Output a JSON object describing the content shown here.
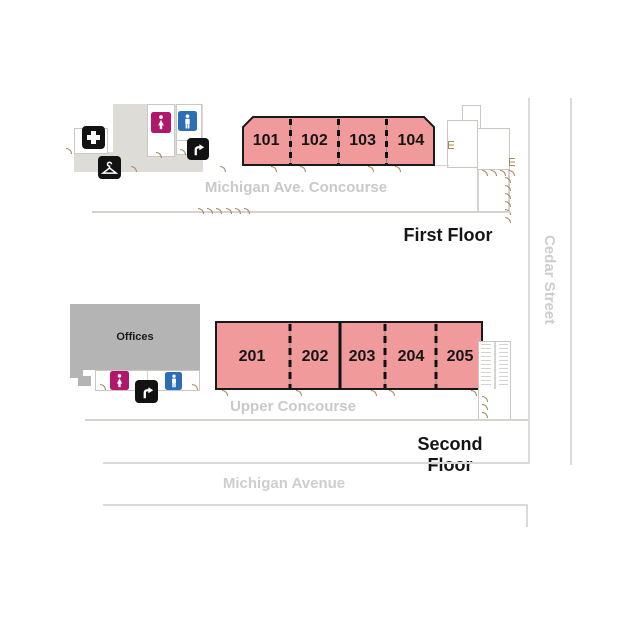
{
  "floors": {
    "first": {
      "title": "First Floor",
      "concourse": "Michigan Ave. Concourse",
      "rooms": [
        "101",
        "102",
        "103",
        "104"
      ]
    },
    "second": {
      "title": "Second Floor",
      "concourse": "Upper Concourse",
      "offices": "Offices",
      "rooms": [
        "201",
        "202",
        "203",
        "204",
        "205"
      ]
    }
  },
  "streets": {
    "cedar": "Cedar Street",
    "michigan": "Michigan Avenue"
  },
  "icons": {
    "first_aid": "first-aid-cross",
    "coat_check": "coat-hanger",
    "womens_restroom": "woman-figure",
    "mens_restroom": "man-figure",
    "escalator": "escalator-up-arrow"
  },
  "colors": {
    "room_fill": "#F19A9B",
    "room_border": "#1A1A1A",
    "footprint_gray": "#DEDCD7",
    "offices_gray": "#B4B4B4",
    "outline_gray": "#CBC8C3",
    "street_line": "#DADADA",
    "label_gray": "#C9C9C9",
    "door_glyph": "#A68B5C",
    "womens_bg": "#B1186C",
    "mens_bg": "#2C6EB5",
    "icon_bg": "#121212"
  }
}
